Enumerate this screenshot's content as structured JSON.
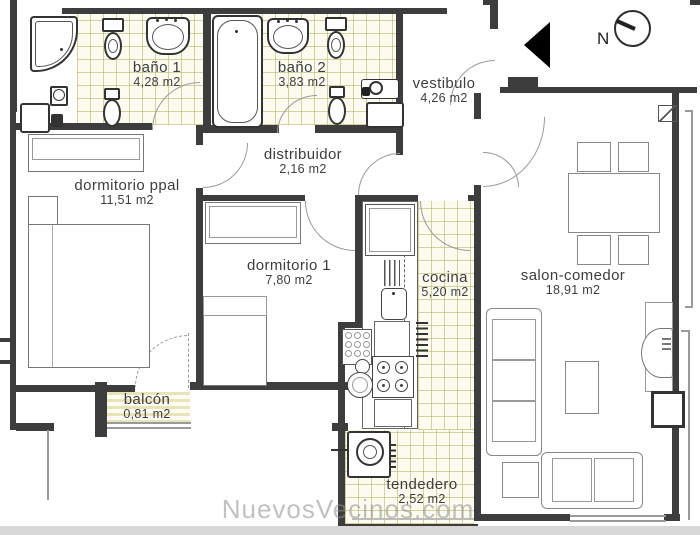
{
  "plan": {
    "watermark": "NuevosVecinos.com",
    "compass_label": "N"
  },
  "rooms": [
    {
      "name": "baño 1",
      "area": "4,28 m2"
    },
    {
      "name": "baño 2",
      "area": "3,83 m2"
    },
    {
      "name": "vestibulo",
      "area": "4,26 m2"
    },
    {
      "name": "distribuidor",
      "area": "2,16 m2"
    },
    {
      "name": "dormitorio ppal",
      "area": "11,51 m2"
    },
    {
      "name": "dormitorio 1",
      "area": "7,80 m2"
    },
    {
      "name": "cocina",
      "area": "5,20 m2"
    },
    {
      "name": "salon-comedor",
      "area": "18,91 m2"
    },
    {
      "name": "balcón",
      "area": "0,81 m2"
    },
    {
      "name": "tendedero",
      "area": "2,52 m2"
    }
  ],
  "colors": {
    "wall": "#3d3d3d",
    "tile_bg": "#fbfbf0",
    "tile_line": "#b0b060",
    "balcony_stripe": "#e9e3b8",
    "watermark": "#909090",
    "bottom_bar": "#d8d8d8"
  }
}
